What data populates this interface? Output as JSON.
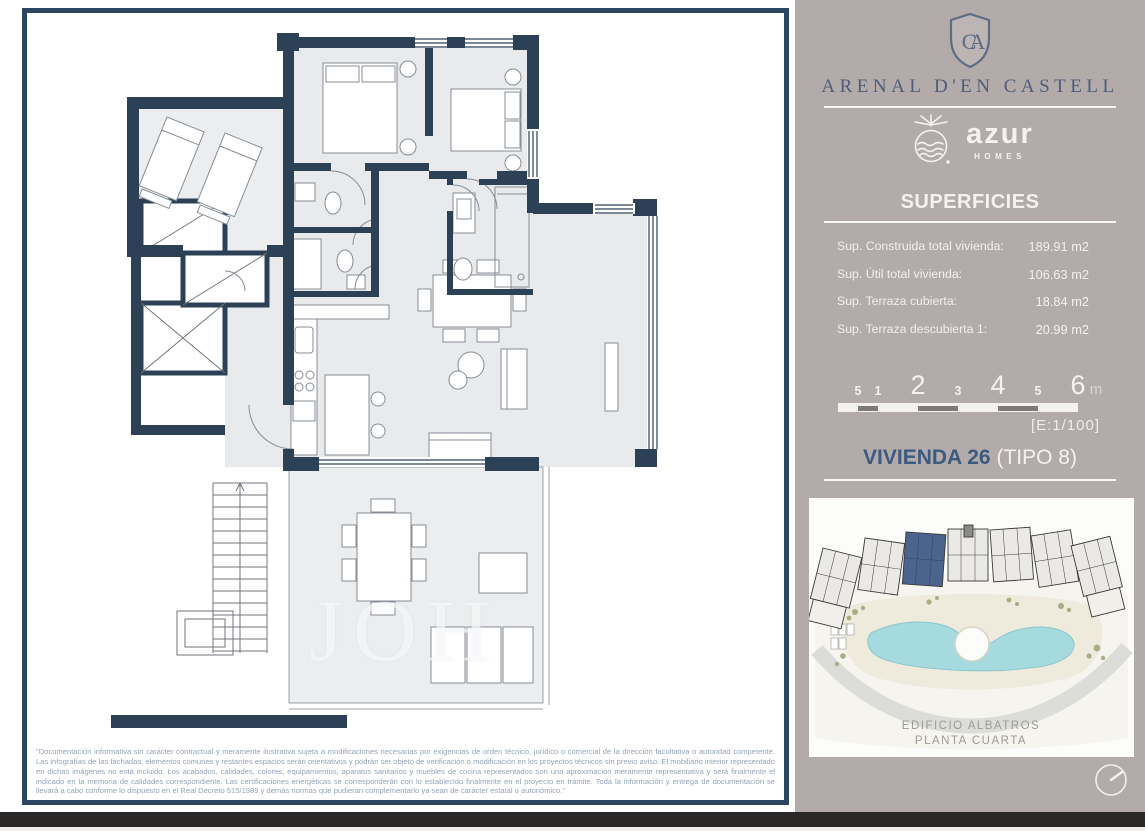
{
  "plan": {
    "watermark": "JOH",
    "disclaimer": "\"Documentación informativa sin carácter contractual y meramente ilustrativa sujeta a modificaciones necesarias por exigencias de orden técnico, jurídico o comercial de la dirección facultativa o autoridad competente. Las infografías de las fachadas, elementos comunes y restantes espacios serán orientativos y podrán ser objeto de verificación o modificación en los proyectos técnicos sin previo aviso. El mobiliario interior representado en dichas imágenes no está incluido. Los acabados, calidades, colores, equipamientos, aparatos sanitarios y muebles de cocina representados son una aproximación meramente representativa y será finalmente el indicado en la memoria de calidades correspondiente. Las certificaciones energéticas se corresponderán con lo establecido finalmente en el proyecto en trámite. Toda la información y entrega de documentación se llevará a cabo conforme lo dispuesto en el Real Decreto 515/1989 y demás normas que pudieran complementarlo ya sean de carácter estatal o autonómico.\""
  },
  "sidebar": {
    "monogram": "CA",
    "project_title": "ARENAL D'EN CASTELL",
    "brand_name": "azur",
    "brand_sub": "HOMES",
    "superficies_title": "SUPERFICIES",
    "superficies_rows": [
      {
        "label": "Sup. Construida total vivienda:",
        "value": "189.91 m2"
      },
      {
        "label": "Sup. Útil total vivienda:",
        "value": "106.63 m2"
      },
      {
        "label": "Sup. Terraza cubierta:",
        "value": "18.84 m2"
      },
      {
        "label": "Sup. Terraza descubierta 1:",
        "value": "20.99 m2"
      }
    ],
    "scalebar": {
      "labels": [
        "5",
        "1",
        "2",
        "3",
        "4",
        "5",
        "6"
      ],
      "unit": "m",
      "scale_note": "[E:1/100]"
    },
    "unit_name": "VIVIENDA 26",
    "unit_type": "(TIPO 8)",
    "siteplan_caption_line1": "EDIFICIO ALBATROS",
    "siteplan_caption_line2": "PLANTA CUARTA"
  },
  "colors": {
    "frame_border": "#2b4663",
    "wall_navy": "#2d4156",
    "sidebar_bg": "#b3abaa",
    "title_navy": "#4d5d7a",
    "unit_navy": "#3d5a80",
    "pool_teal": "#a5dade",
    "highlight_unit": "#4a648e",
    "bottom_bar": "#2b2928"
  }
}
